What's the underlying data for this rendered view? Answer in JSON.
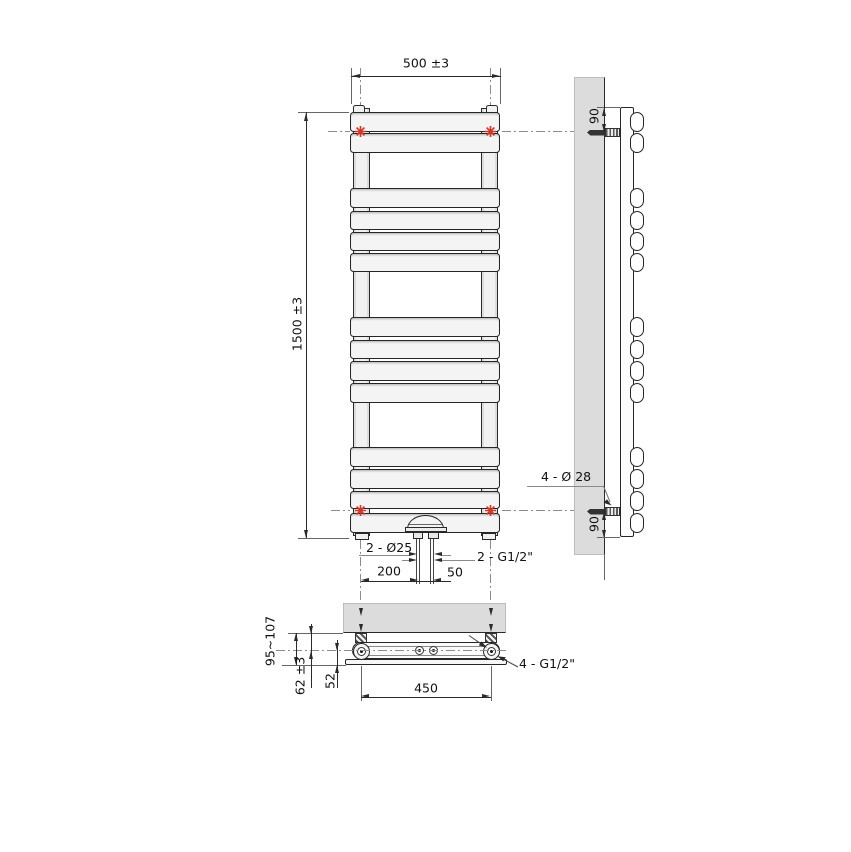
{
  "drawing": {
    "type": "technical-drawing-towel-radiator",
    "front_view": {
      "dim_width": "500 ±3",
      "dim_height": "1500 ±3",
      "label_pipes": "2 - Ø25",
      "label_connections": "2 - G1/2\"",
      "dim_pipe_offset": "200",
      "dim_pipe_spacing": "50"
    },
    "side_view": {
      "dim_top_bracket": "90",
      "dim_bottom_bracket": "90",
      "label_bracket_holes": "4 - Ø 28"
    },
    "bottom_view": {
      "dim_depth_range": "95~107",
      "dim_wall_to_axis": "62 ±3",
      "dim_axis_to_front": "52",
      "dim_bracket_spacing": "450",
      "label_connections": "4 - G1/2\""
    },
    "colors": {
      "marker_red": "#d63425",
      "wall_gray": "#dcdcdc",
      "line": "#2a2a2a"
    }
  }
}
